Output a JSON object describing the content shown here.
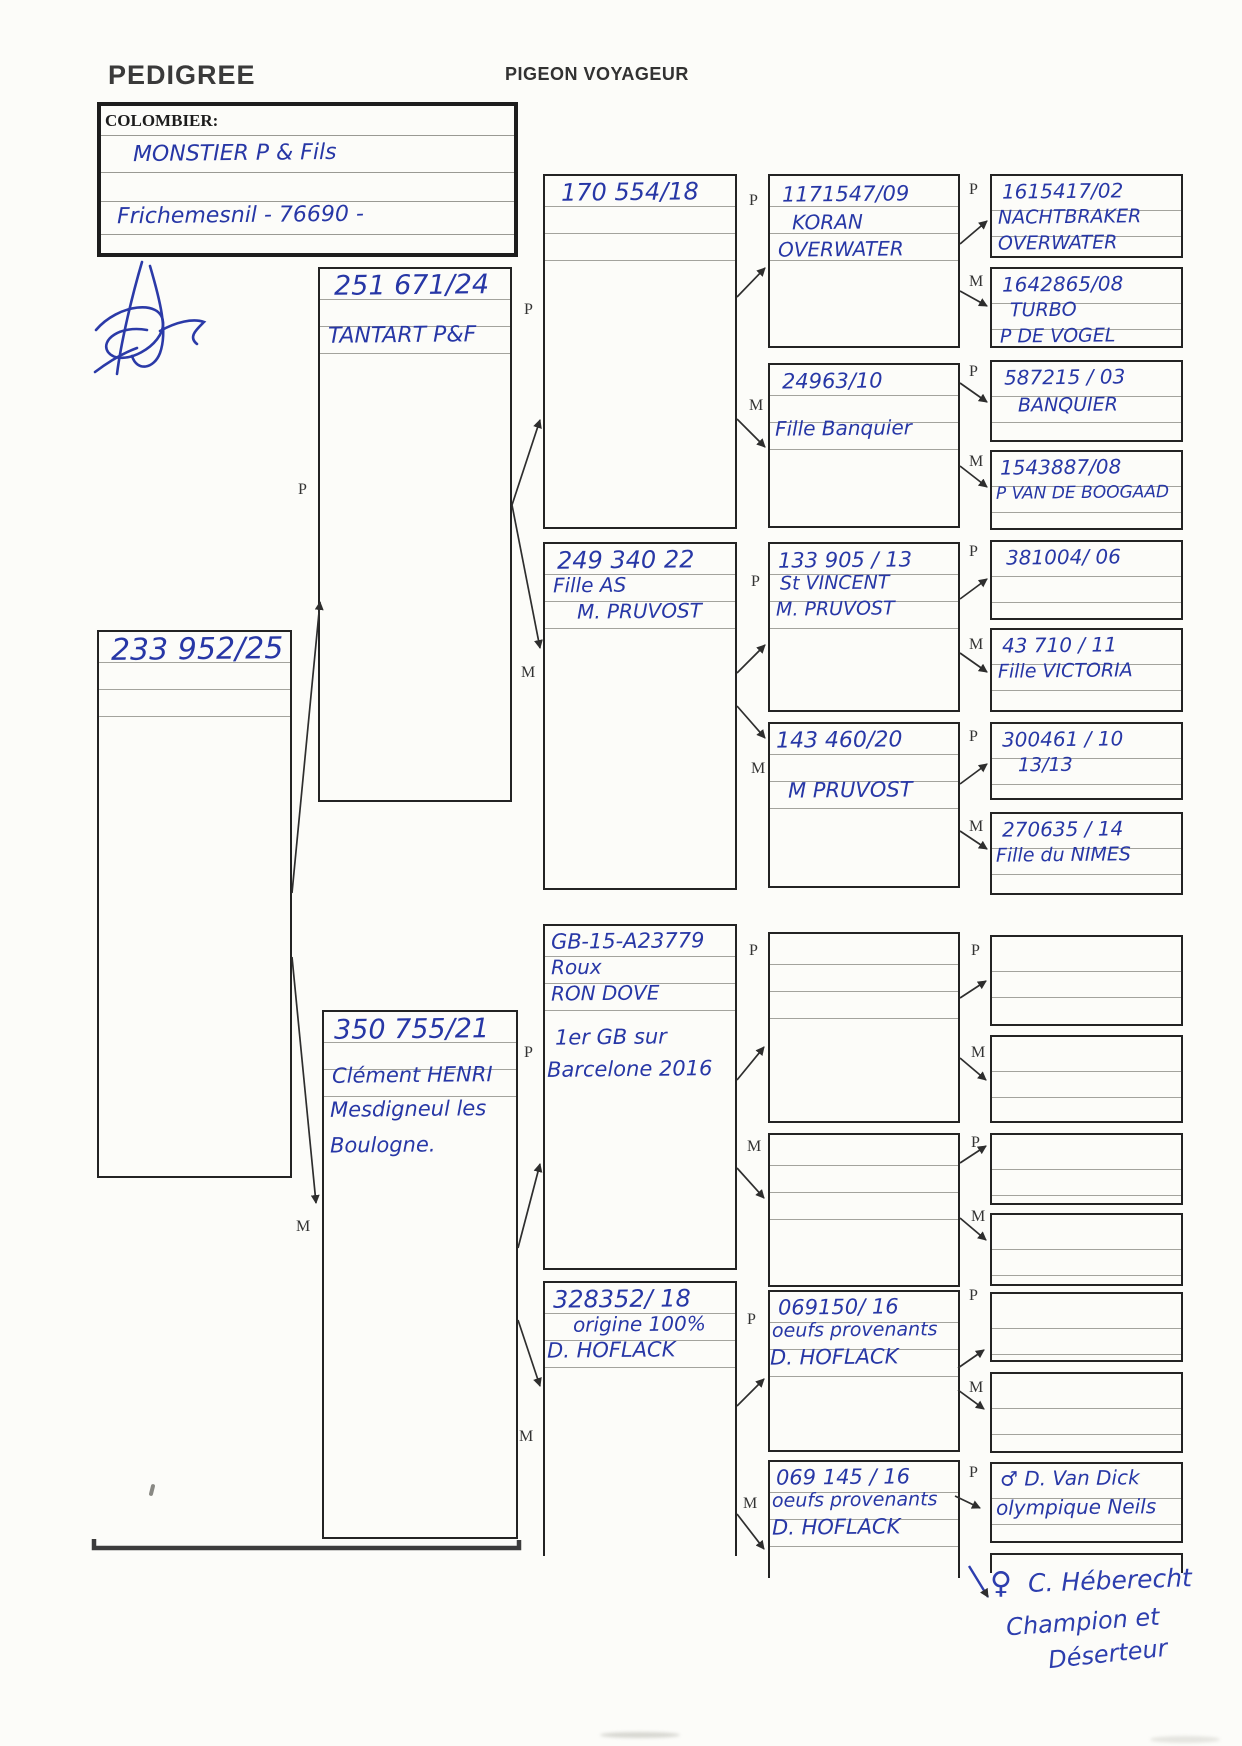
{
  "header": {
    "title": "PEDIGREE",
    "subtitle": "PIGEON VOYAGEUR"
  },
  "colombier": {
    "label": "COLOMBIER:",
    "owner": "MONSTIER P & Fils",
    "address": "Frichemesnil - 76690 -"
  },
  "labels": {
    "father": "P",
    "mother": "M"
  },
  "subject": {
    "ring": "233 952/25"
  },
  "gen2": {
    "father": {
      "ring": "251 671/24",
      "line2": "TANTART P&F"
    },
    "mother": {
      "ring": "350 755/21",
      "line2": "Clément HENRI",
      "line3": "Mesdigneul les",
      "line4": "Boulogne."
    }
  },
  "gen3": {
    "b1": {
      "ring": "170 554/18"
    },
    "b2": {
      "ring": "249 340  22",
      "line2": "Fille AS",
      "line3": "M. PRUVOST"
    },
    "b3": {
      "ring": "GB-15-A23779",
      "line2": "Roux",
      "line3": "RON DOVE",
      "line4": "1er GB sur",
      "line5": "Barcelone 2016"
    },
    "b4": {
      "ring": "328352/ 18",
      "line2": "origine 100%",
      "line3": "D. HOFLACK"
    }
  },
  "gen4": {
    "b1": {
      "ring": "1171547/09",
      "line2": "KORAN",
      "line3": "OVERWATER"
    },
    "b2": {
      "ring": "24963/10",
      "line2": "Fille Banquier"
    },
    "b3": {
      "ring": "133 905 / 13",
      "line2": "St VINCENT",
      "line3": "M. PRUVOST"
    },
    "b4": {
      "ring": "143 460/20",
      "line2": "M PRUVOST"
    },
    "b7": {
      "ring": "069150/ 16",
      "line2": "oeufs provenants",
      "line3": "D. HOFLACK"
    },
    "b8": {
      "ring": "069 145 / 16",
      "line2": "oeufs provenants",
      "line3": "D. HOFLACK"
    }
  },
  "gen5": {
    "b1": {
      "line1": "1615417/02",
      "line2": "NACHTBRAKER",
      "line3": "OVERWATER"
    },
    "b2": {
      "line1": "1642865/08",
      "line2": "TURBO",
      "line3": "P DE VOGEL"
    },
    "b3": {
      "line1": "587215 / 03",
      "line2": "BANQUIER"
    },
    "b4": {
      "line1": "1543887/08",
      "line2": "P VAN DE BOOGAAD"
    },
    "b5": {
      "line1": "381004/ 06"
    },
    "b6": {
      "line1": "43 710 / 11",
      "line2": "Fille VICTORIA"
    },
    "b7": {
      "line1": "300461 / 10",
      "line2": "13/13"
    },
    "b8": {
      "line1": "270635 / 14",
      "line2": "Fille du NIMES"
    },
    "b15": {
      "line1": "♂ D. Van Dick",
      "line2": "olympique Neils"
    }
  },
  "annotation": {
    "symbol": "♀",
    "line1": "C. Héberecht",
    "line2": "Champion et",
    "line3": "Déserteur"
  }
}
